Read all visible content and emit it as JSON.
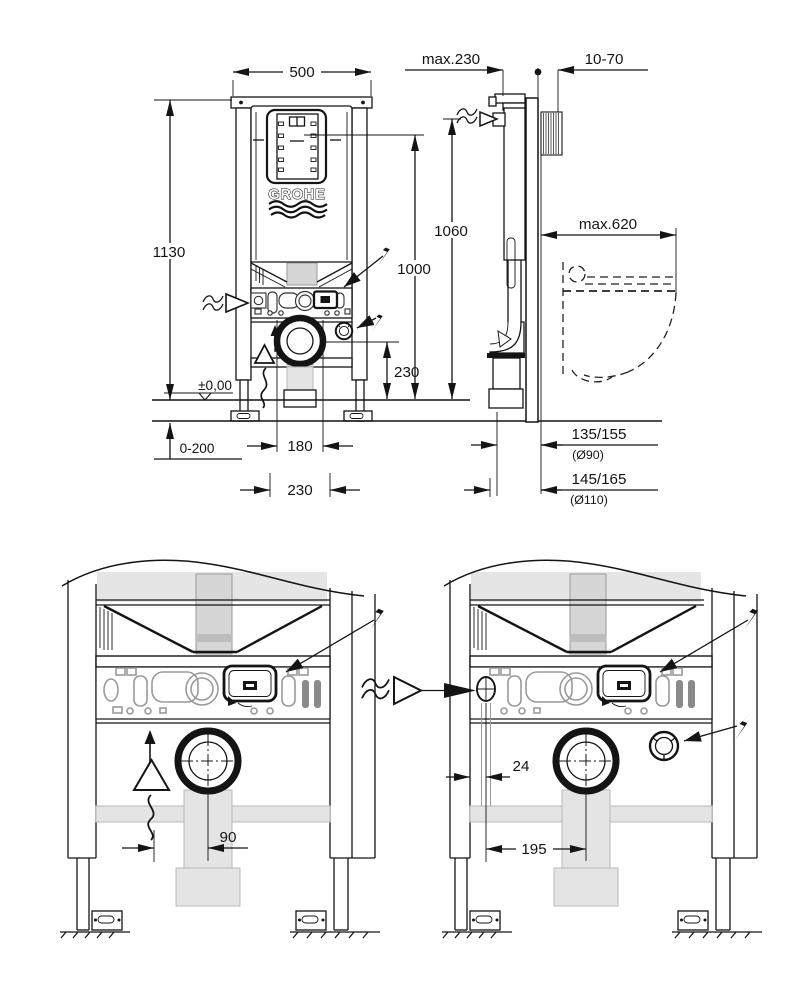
{
  "brand": {
    "logo": "GROHE"
  },
  "colors": {
    "line": "#141414",
    "component_gray": "#d6d6d6",
    "background": "#ffffff"
  },
  "icons": {
    "electric": "lightning-bolt",
    "water_supply": "wavy-arrow",
    "vent": "up-arrow-with-wave",
    "floor_level": "inverted-triangle-level-marker"
  },
  "front": {
    "dim_width": "500",
    "dim_height": "1130",
    "dim_plate_height": "1000",
    "dim_supply_height": "1060",
    "dim_drain_height": "230",
    "floor_level": "±0,00",
    "dim_leg_range": "0-200",
    "dim_fixing_inner": "180",
    "dim_fixing_outer": "230"
  },
  "side": {
    "dim_frame_depth": "max.230",
    "dim_wall_clearance": "10-70",
    "dim_bowl_depth": "max.620",
    "dim_outlet_90": "135/155",
    "outlet_90_dia": "(Ø90)",
    "dim_outlet_110": "145/165",
    "outlet_110_dia": "(Ø110)"
  },
  "detail_left": {
    "dim_outlet_offset": "90"
  },
  "detail_right": {
    "dim_supply_offset": "24",
    "dim_outlet_offset": "195"
  }
}
